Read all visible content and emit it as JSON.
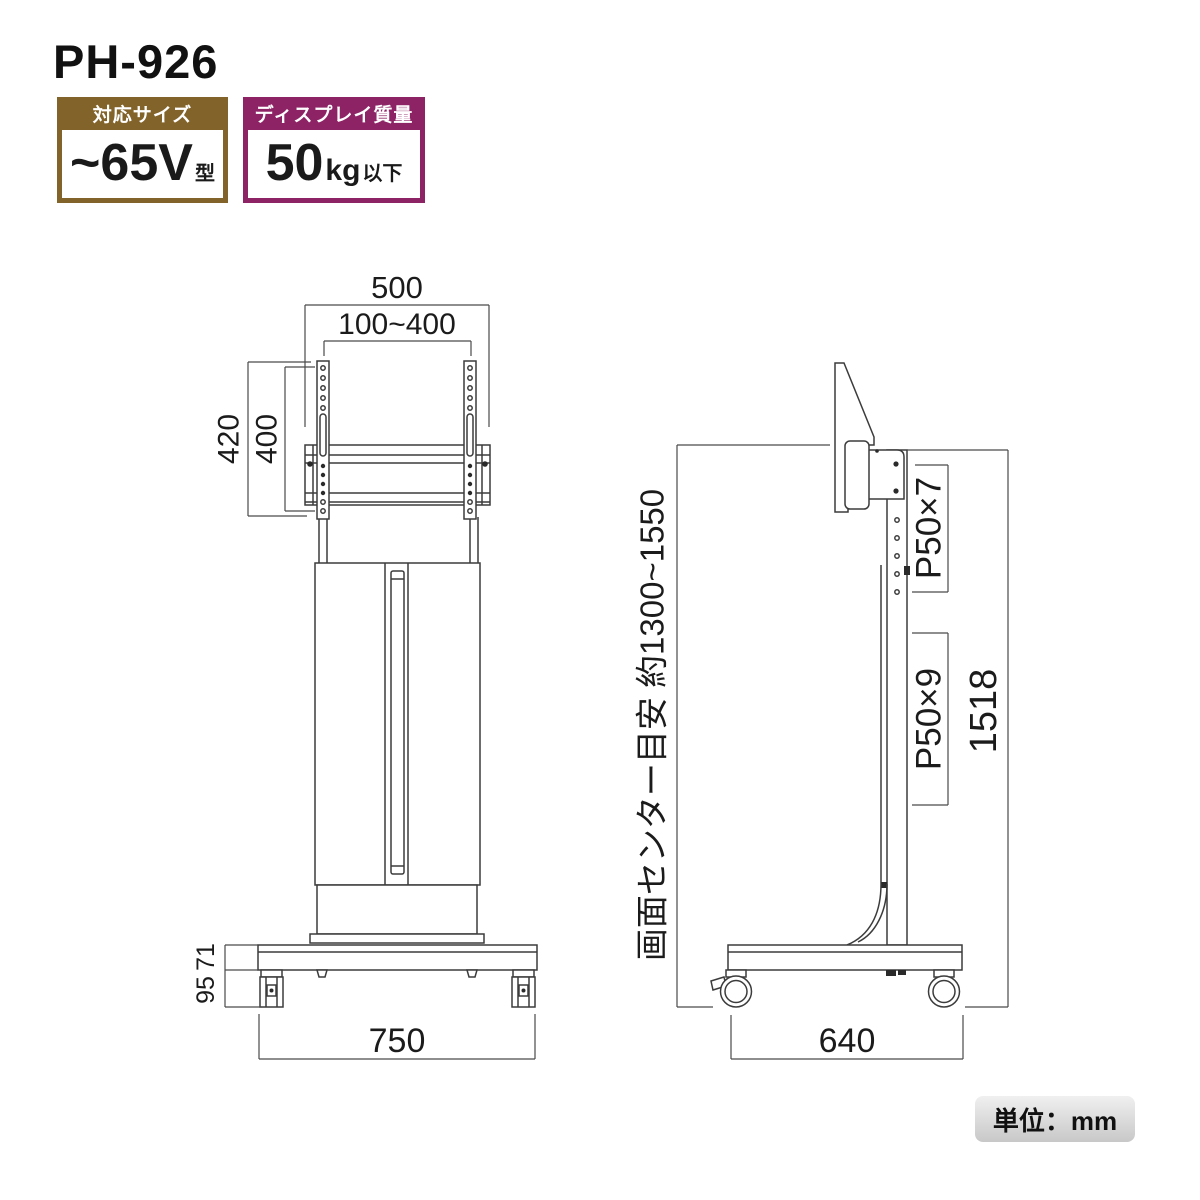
{
  "page": {
    "title": "PH-926",
    "unit_label": "単位：mm"
  },
  "badges": {
    "size": {
      "header": "対応サイズ",
      "value": "~65V",
      "suffix": "型"
    },
    "weight": {
      "header": "ディスプレイ質量",
      "value": "50",
      "unit": "kg",
      "suffix": "以下"
    }
  },
  "front_view": {
    "dims": {
      "overall_width": "500",
      "vesa_width": "100~400",
      "bracket_height": "420",
      "vesa_height": "400",
      "base_top_height": "71",
      "base_height": "95",
      "base_width": "750"
    }
  },
  "side_view": {
    "dims": {
      "screen_center_note": "画面センター目安 約1300~1550",
      "upper_pitch": "P50×7",
      "lower_pitch": "P50×9",
      "overall_height": "1518",
      "base_depth": "640"
    }
  },
  "colors": {
    "size_badge": "#82632a",
    "weight_badge": "#8d2365",
    "line": "#3c3c3c",
    "unit_bg": "#d6d6d6"
  }
}
